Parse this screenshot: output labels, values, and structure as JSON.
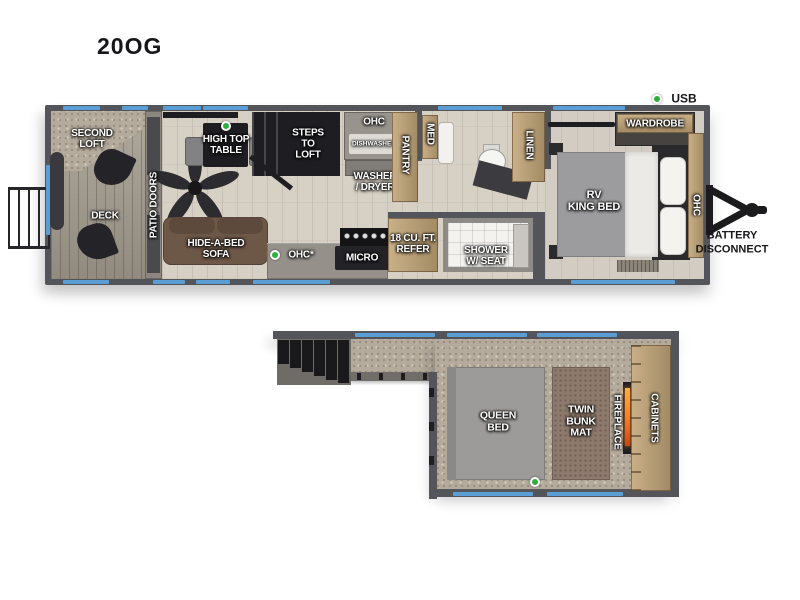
{
  "title": "20OG",
  "colors": {
    "wall": "#54555a",
    "window_blue": "#5b9ed6",
    "accent_green": "#2fae3e",
    "wood_floor": "#d7d0c5",
    "carpet": "#b5ab9d",
    "cabinet_tan": "#b79e79",
    "sofa_brown": "#6d5747",
    "flame_orange": "#ff8c2a"
  },
  "main_floor": {
    "labels": {
      "second_loft": "SECOND\nLOFT",
      "deck": "DECK",
      "patio_doors": "PATIO DOORS",
      "high_top_table": "HIGH TOP\nTABLE",
      "steps_to_loft": "STEPS\nTO\nLOFT",
      "hide_a_bed_sofa": "HIDE-A-BED\nSOFA",
      "ohc_kitchen": "OHC*",
      "micro": "MICRO",
      "ohc_galley": "OHC",
      "dishwasher": "DISHWASHER",
      "washer_dryer": "WASHER\n/ DRYER",
      "pantry": "PANTRY",
      "med": "MED",
      "refer": "18 CU. FT.\nREFER",
      "shower": "SHOWER\nW/ SEAT",
      "linen": "LINEN",
      "rv_king_bed": "RV\nKING BED",
      "wardrobe": "WARDROBE",
      "ohc_bedroom": "OHC"
    },
    "callouts": {
      "usb": "USB",
      "battery_disconnect": "BATTERY\nDISCONNECT"
    }
  },
  "loft_floor": {
    "labels": {
      "queen_bed": "QUEEN\nBED",
      "twin_bunk_mat": "TWIN\nBUNK\nMAT",
      "fireplace": "FIREPLACE",
      "cabinets": "CABINETS"
    }
  }
}
